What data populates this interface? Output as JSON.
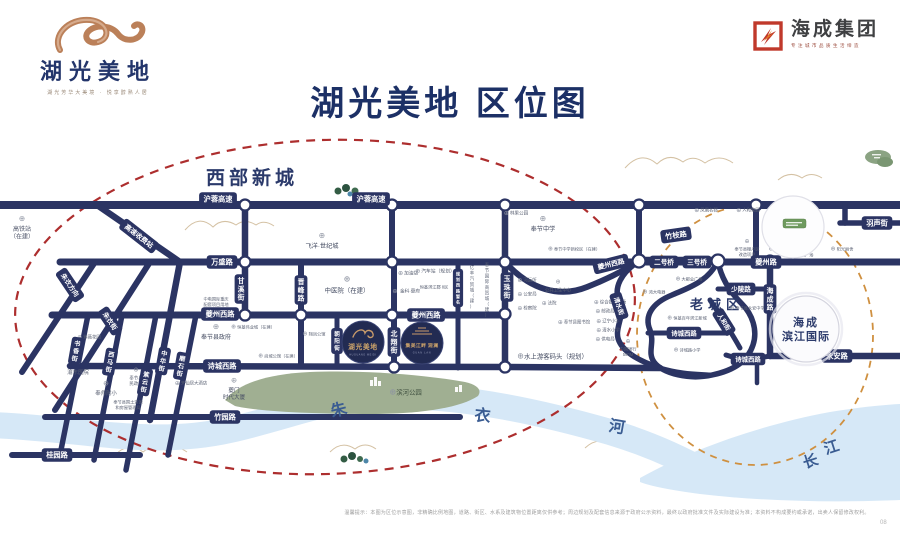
{
  "header": {
    "logo": {
      "name": "湖光美地",
      "tagline": "湖光芳华大美境 · 悦享醇熟人居"
    },
    "brand": {
      "name": "海成集团",
      "tagline": "专注城市品质生活缔造"
    },
    "title": "湖光美地 区位图"
  },
  "map": {
    "areas": [
      {
        "t": "西部新城",
        "x": 206,
        "y": 184,
        "fs": 19,
        "ls": 4
      },
      {
        "t": "老城区",
        "x": 690,
        "y": 309,
        "fs": 13,
        "ls": 5
      }
    ],
    "river_chars": [
      {
        "t": "朱",
        "x": 340,
        "y": 415,
        "r": -14,
        "fs": 16
      },
      {
        "t": "衣",
        "x": 482,
        "y": 421,
        "r": 6,
        "fs": 16
      },
      {
        "t": "河",
        "x": 616,
        "y": 432,
        "r": 10,
        "fs": 16
      },
      {
        "t": "长",
        "x": 812,
        "y": 466,
        "r": -18,
        "fs": 15
      },
      {
        "t": "江",
        "x": 833,
        "y": 452,
        "r": -18,
        "fs": 15
      }
    ],
    "road_pills": [
      {
        "t": "沪蓉高速",
        "x": 218,
        "y": 199
      },
      {
        "t": "沪蓉高速",
        "x": 371,
        "y": 199
      },
      {
        "t": "高速收费站",
        "x": 139,
        "y": 236,
        "r": 38,
        "fs": 6.8
      },
      {
        "t": "万盛路",
        "x": 222,
        "y": 262
      },
      {
        "t": "甘溪街",
        "x": 241,
        "y": 289,
        "v": 1
      },
      {
        "t": "晋峰路",
        "x": 301,
        "y": 290,
        "v": 1
      },
      {
        "t": "朝阳街",
        "x": 337,
        "y": 341,
        "v": 1,
        "fs": 5.6
      },
      {
        "t": "夔州西路",
        "x": 220,
        "y": 314
      },
      {
        "t": "夔州西路",
        "x": 426,
        "y": 315
      },
      {
        "t": "夔州西路",
        "x": 611,
        "y": 264,
        "r": -14,
        "fs": 6.8
      },
      {
        "t": "诗城西路",
        "x": 222,
        "y": 366
      },
      {
        "t": "竹园路",
        "x": 225,
        "y": 417
      },
      {
        "t": "桂园路",
        "x": 57,
        "y": 455
      },
      {
        "t": "朱衣方向",
        "x": 70,
        "y": 285,
        "r": 56,
        "fs": 6.6
      },
      {
        "t": "朱衣街",
        "x": 110,
        "y": 321,
        "r": 56,
        "fs": 6.6
      },
      {
        "t": "书香街",
        "x": 76,
        "y": 351,
        "v": 1,
        "r": 10,
        "fs": 6.2
      },
      {
        "t": "西马街",
        "x": 110,
        "y": 362,
        "v": 1,
        "r": 10,
        "fs": 6.2
      },
      {
        "t": "紫云街",
        "x": 145,
        "y": 382,
        "v": 1,
        "r": 10,
        "fs": 6.2
      },
      {
        "t": "中华街",
        "x": 163,
        "y": 361,
        "v": 1,
        "r": 10,
        "fs": 6.2
      },
      {
        "t": "磨石街",
        "x": 181,
        "y": 366,
        "v": 1,
        "r": 10,
        "fs": 6.2
      },
      {
        "t": "北翔街",
        "x": 394,
        "y": 342,
        "v": 1
      },
      {
        "t": "规划西路暂名",
        "x": 458,
        "y": 288,
        "v": 1,
        "fs": 4.2
      },
      {
        "t": "玉珠街",
        "x": 507,
        "y": 287,
        "v": 1
      },
      {
        "t": "二号桥",
        "x": 664,
        "y": 262,
        "fs": 6.6
      },
      {
        "t": "三号桥",
        "x": 697,
        "y": 262,
        "fs": 6.6
      },
      {
        "t": "夔州路",
        "x": 766,
        "y": 262
      },
      {
        "t": "竹枝路",
        "x": 676,
        "y": 235,
        "r": -8
      },
      {
        "t": "少陵路",
        "x": 741,
        "y": 289,
        "fs": 6.6
      },
      {
        "t": "人和街",
        "x": 724,
        "y": 322,
        "r": 58,
        "fs": 6.2
      },
      {
        "t": "清水街",
        "x": 619,
        "y": 306,
        "r": 72,
        "fs": 6.2
      },
      {
        "t": "诗城西路",
        "x": 684,
        "y": 333,
        "fs": 6.4
      },
      {
        "t": "诗城西路",
        "x": 748,
        "y": 359,
        "fs": 6.4
      },
      {
        "t": "海成路",
        "x": 770,
        "y": 299,
        "v": 1
      },
      {
        "t": "永安路",
        "x": 837,
        "y": 356
      },
      {
        "t": "羽声街",
        "x": 877,
        "y": 223
      }
    ],
    "nodes": [
      {
        "x": 245,
        "y": 205
      },
      {
        "x": 392,
        "y": 205
      },
      {
        "x": 505,
        "y": 205
      },
      {
        "x": 639,
        "y": 205
      },
      {
        "x": 756,
        "y": 205
      },
      {
        "x": 245,
        "y": 262
      },
      {
        "x": 392,
        "y": 262
      },
      {
        "x": 505,
        "y": 262
      },
      {
        "x": 639,
        "y": 261,
        "r": 6.5
      },
      {
        "x": 718,
        "y": 261,
        "r": 6.5
      },
      {
        "x": 770,
        "y": 261
      },
      {
        "x": 245,
        "y": 315
      },
      {
        "x": 301,
        "y": 315
      },
      {
        "x": 392,
        "y": 315
      },
      {
        "x": 505,
        "y": 314
      },
      {
        "x": 394,
        "y": 367
      },
      {
        "x": 505,
        "y": 367
      }
    ],
    "pois": [
      {
        "l": [
          "高铁站",
          "（在建）"
        ],
        "x": 22,
        "y": 229,
        "i": "a",
        "fs": 6,
        "c": "#4a5166"
      },
      {
        "t": "紫薇花园",
        "x": 92,
        "y": 337,
        "i": "l",
        "fs": 4.4
      },
      {
        "t": "渝东医院",
        "x": 78,
        "y": 372,
        "i": "a",
        "fs": 5.4
      },
      {
        "t": "奉师附小",
        "x": 106,
        "y": 393,
        "i": "a",
        "fs": 5.4
      },
      {
        "l": [
          "奉节县",
          "民政局"
        ],
        "x": 136,
        "y": 378,
        "i": "a",
        "fs": 4.4
      },
      {
        "l": [
          "奉节县国土资源",
          "和房屋管理局"
        ],
        "x": 128,
        "y": 402,
        "fs": 4.2
      },
      {
        "t": "天仙居大酒店",
        "x": 194,
        "y": 383,
        "i": "l",
        "fs": 4.4
      },
      {
        "l": [
          "夔门",
          "时代大厦"
        ],
        "x": 234,
        "y": 390,
        "i": "a",
        "fs": 5.6,
        "c": "#4a5166"
      },
      {
        "t": "奉节县政府",
        "x": 216,
        "y": 337,
        "i": "a",
        "fs": 6,
        "c": "#434b61"
      },
      {
        "l": [
          "中电国际重庆",
          "配套项目用地"
        ],
        "x": 216,
        "y": 299,
        "fs": 4.2
      },
      {
        "t": "恒基伟业城（在建）",
        "x": 256,
        "y": 327,
        "i": "l",
        "fs": 4.2
      },
      {
        "t": "尚城公馆（在建）",
        "x": 281,
        "y": 356,
        "i": "l",
        "fs": 4.2
      },
      {
        "t": "翔凤公馆",
        "x": 317,
        "y": 334,
        "i": "l",
        "fs": 4.2
      },
      {
        "t": "飞洋·世纪城",
        "x": 322,
        "y": 246,
        "i": "a",
        "fs": 6.2,
        "c": "#434b61"
      },
      {
        "t": "中医院（在建）",
        "x": 347,
        "y": 290,
        "i": "a",
        "fs": 6.4,
        "c": "#434b61"
      },
      {
        "t": "加油站",
        "x": 411,
        "y": 273,
        "i": "l",
        "fs": 4.6
      },
      {
        "t": "金科·夔府",
        "x": 410,
        "y": 291,
        "i": "l",
        "fs": 4.6
      },
      {
        "t": "汽车站（规划）",
        "x": 438,
        "y": 271,
        "i": "l",
        "fs": 4.8
      },
      {
        "t": "恒基滨江郡 8区",
        "x": 434,
        "y": 287,
        "fs": 4.2
      },
      {
        "t": "亿丰汽贸城（建）",
        "x": 472,
        "y": 287,
        "v": 1,
        "fs": 4.4
      },
      {
        "t": "奉节国际商贸城（建）",
        "x": 487,
        "y": 290,
        "v": 1,
        "fs": 4.4
      },
      {
        "t": "奉节中学",
        "x": 543,
        "y": 229,
        "i": "a",
        "fs": 6.2,
        "c": "#434b61"
      },
      {
        "t": "林果公园",
        "x": 519,
        "y": 213,
        "i": "l",
        "fs": 4.6
      },
      {
        "t": "奉节中学新校区（在建）",
        "x": 577,
        "y": 249,
        "i": "l",
        "fs": 4.2
      },
      {
        "t": "河运所",
        "x": 530,
        "y": 280,
        "i": "l",
        "fs": 4.4
      },
      {
        "t": "公安局",
        "x": 530,
        "y": 294,
        "i": "l",
        "fs": 4.4
      },
      {
        "t": "检察院",
        "x": 530,
        "y": 308,
        "i": "l",
        "fs": 4.4
      },
      {
        "t": "法院",
        "x": 552,
        "y": 303,
        "i": "l",
        "fs": 4.4
      },
      {
        "t": "公共卫生中心",
        "x": 558,
        "y": 290,
        "i": "a",
        "fs": 4.4
      },
      {
        "t": "奉节县图书馆",
        "x": 577,
        "y": 322,
        "i": "l",
        "fs": 4.4
      },
      {
        "t": "综合批发市场",
        "x": 613,
        "y": 302,
        "i": "l",
        "fs": 4.4
      },
      {
        "t": "邮政局",
        "x": 608,
        "y": 311,
        "i": "l",
        "fs": 4.4
      },
      {
        "t": "辽宁小学",
        "x": 611,
        "y": 321,
        "i": "l",
        "fs": 4.4
      },
      {
        "t": "清水小学",
        "x": 611,
        "y": 330,
        "i": "l",
        "fs": 4.4
      },
      {
        "t": "供电局",
        "x": 608,
        "y": 339,
        "i": "l",
        "fs": 4.4
      },
      {
        "t": "水上游客码头（规划）",
        "x": 556,
        "y": 356,
        "i": "l",
        "fs": 6.4,
        "c": "#434b61"
      },
      {
        "l": [
          "中国银行",
          "500M"
        ],
        "x": 628,
        "y": 349,
        "i": "a",
        "fs": 4.2
      },
      {
        "t": "凤凰名郡",
        "x": 709,
        "y": 210,
        "i": "l",
        "fs": 4.4
      },
      {
        "t": "人和家园",
        "x": 751,
        "y": 210,
        "i": "l",
        "fs": 4.4
      },
      {
        "l": [
          "奉节县棚户区",
          "改造项目"
        ],
        "x": 747,
        "y": 249,
        "i": "a",
        "fs": 4.2
      },
      {
        "t": "大都会广场",
        "x": 692,
        "y": 279,
        "i": "l",
        "fs": 4.2
      },
      {
        "t": "鸿大电器",
        "x": 657,
        "y": 292,
        "i": "l",
        "fs": 4.2
      },
      {
        "t": "恒基百年滨江新城",
        "x": 690,
        "y": 318,
        "i": "l",
        "fs": 4.2
      },
      {
        "t": "诗城路小学",
        "x": 690,
        "y": 350,
        "i": "l",
        "fs": 4.2
      },
      {
        "t": "奉节县永安中学",
        "x": 750,
        "y": 308,
        "i": "l",
        "fs": 4.2
      },
      {
        "t": "亿联时代广场",
        "x": 790,
        "y": 210,
        "i": "l",
        "fs": 4.2
      },
      {
        "t": "广电大楼",
        "x": 806,
        "y": 241,
        "i": "l",
        "fs": 4.2
      },
      {
        "t": "羊子公园",
        "x": 783,
        "y": 249,
        "i": "l",
        "fs": 4.2
      },
      {
        "t": "亿联广场",
        "x": 805,
        "y": 255,
        "i": "l",
        "fs": 4.2
      },
      {
        "t": "阳光丽舍",
        "x": 845,
        "y": 249,
        "i": "l",
        "fs": 4.2
      },
      {
        "t": "滨河公园",
        "x": 409,
        "y": 392,
        "i": "l",
        "fs": 6.4,
        "c": "#3e4f3f"
      }
    ],
    "projects": {
      "p1": {
        "name": "湖光美地",
        "sub": "HUGUANG MEIDI"
      },
      "p2": {
        "name": "集美江畔 观澜",
        "sub": "GUAN LAN"
      }
    },
    "landmark": {
      "line1": "海成",
      "line2": "滨江国际"
    },
    "colors": {
      "road": "#2b3463",
      "red_ellipse": "#ad2e2e",
      "orange_ellipse": "#cf9040",
      "river": "#d6e8f7",
      "park": "#a0af92",
      "gold": "#c89a6a",
      "navy_text": "#2b3a6b"
    }
  },
  "footer": {
    "disclaimer": "温馨提示：本图为区位示意图，非精确比例地图，道路、街区、水系及建筑物位置距离仅供参考；周边规划及配套信息来源于政府公示资料，最终以政府批准文件及实际建设为准；本资料不构成要约或承诺，出卖人保留修改权利。",
    "page": "08"
  }
}
